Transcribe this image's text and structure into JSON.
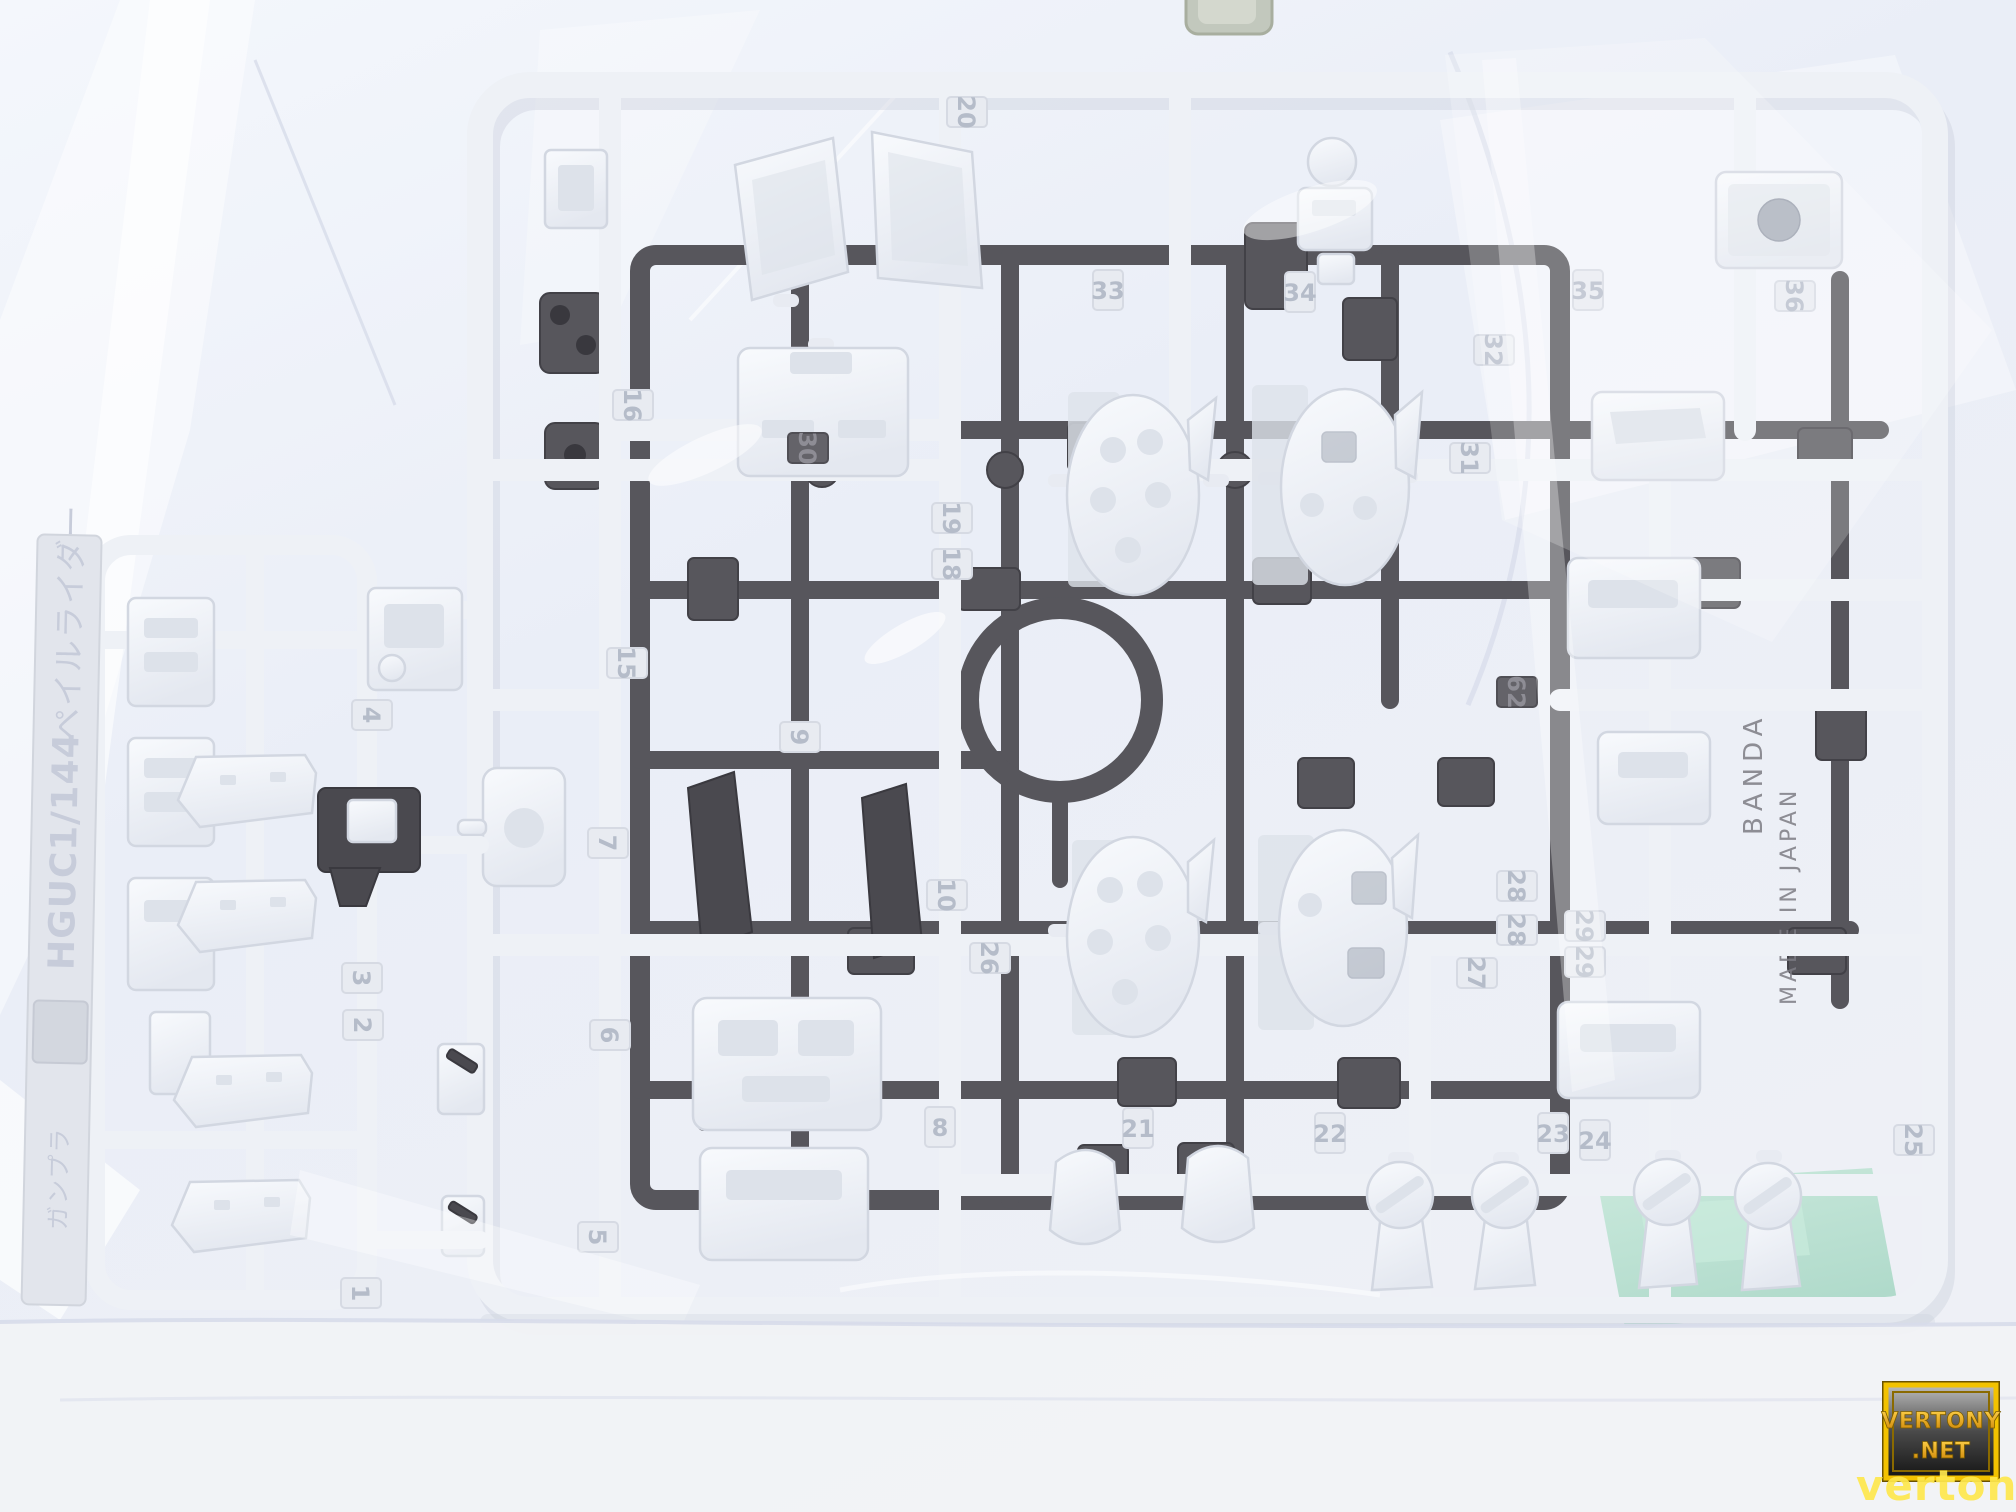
{
  "colors": {
    "bag_bg": "#edf1f9",
    "white_plastic": "#eef1f6",
    "gray_plastic": "#57565c",
    "green_paper": "#b5dfcf",
    "watermark_gold": "#f2a900",
    "watermark_overlay": "#ffe84d"
  },
  "runner_tag": {
    "scale": "HGUC1/144",
    "kit_name": "ペイルライダー",
    "runner_letter": "A",
    "embossed_note": "ガンプラ"
  },
  "gray_runner_embossed": {
    "brand": "BANDAI",
    "origin": "MADE IN JAPAN"
  },
  "watermark": {
    "badge_line1": "VERTONY",
    "badge_line2": ".NET",
    "overlay_text": "vertony.net"
  },
  "part_numbers": [
    {
      "n": "20",
      "x": 967,
      "y": 112,
      "r": 90
    },
    {
      "n": "16",
      "x": 633,
      "y": 405,
      "r": 90
    },
    {
      "n": "15",
      "x": 627,
      "y": 663,
      "r": 90
    },
    {
      "n": "19",
      "x": 952,
      "y": 518,
      "r": 90
    },
    {
      "n": "18",
      "x": 952,
      "y": 564,
      "r": 90
    },
    {
      "n": "33",
      "x": 1108,
      "y": 290,
      "r": 0
    },
    {
      "n": "34",
      "x": 1300,
      "y": 292,
      "r": 0
    },
    {
      "n": "35",
      "x": 1588,
      "y": 290,
      "r": 0
    },
    {
      "n": "36",
      "x": 1795,
      "y": 296,
      "r": 90
    },
    {
      "n": "32",
      "x": 1494,
      "y": 350,
      "r": 90
    },
    {
      "n": "31",
      "x": 1470,
      "y": 458,
      "r": 90
    },
    {
      "n": "30",
      "x": 808,
      "y": 448,
      "r": 90,
      "host": "gray"
    },
    {
      "n": "62",
      "x": 1517,
      "y": 692,
      "r": 90,
      "host": "gray"
    },
    {
      "n": "9",
      "x": 800,
      "y": 737,
      "r": 90
    },
    {
      "n": "10",
      "x": 947,
      "y": 895,
      "r": 90
    },
    {
      "n": "26",
      "x": 990,
      "y": 958,
      "r": 90
    },
    {
      "n": "28",
      "x": 1517,
      "y": 886,
      "r": 90
    },
    {
      "n": "28",
      "x": 1517,
      "y": 930,
      "r": 90
    },
    {
      "n": "27",
      "x": 1477,
      "y": 973,
      "r": 90
    },
    {
      "n": "29",
      "x": 1585,
      "y": 926,
      "r": 90
    },
    {
      "n": "29",
      "x": 1585,
      "y": 962,
      "r": 90
    },
    {
      "n": "7",
      "x": 608,
      "y": 843,
      "r": 90
    },
    {
      "n": "6",
      "x": 610,
      "y": 1035,
      "r": 90
    },
    {
      "n": "5",
      "x": 598,
      "y": 1237,
      "r": 90
    },
    {
      "n": "8",
      "x": 940,
      "y": 1127,
      "r": 0
    },
    {
      "n": "21",
      "x": 1138,
      "y": 1128,
      "r": 0
    },
    {
      "n": "22",
      "x": 1330,
      "y": 1133,
      "r": 0
    },
    {
      "n": "23",
      "x": 1553,
      "y": 1133,
      "r": 0
    },
    {
      "n": "24",
      "x": 1595,
      "y": 1140,
      "r": 0
    },
    {
      "n": "25",
      "x": 1914,
      "y": 1140,
      "r": 90
    },
    {
      "n": "4",
      "x": 372,
      "y": 715,
      "r": 90
    },
    {
      "n": "3",
      "x": 362,
      "y": 978,
      "r": 90
    },
    {
      "n": "2",
      "x": 363,
      "y": 1025,
      "r": 90
    },
    {
      "n": "1",
      "x": 361,
      "y": 1293,
      "r": 90
    }
  ]
}
